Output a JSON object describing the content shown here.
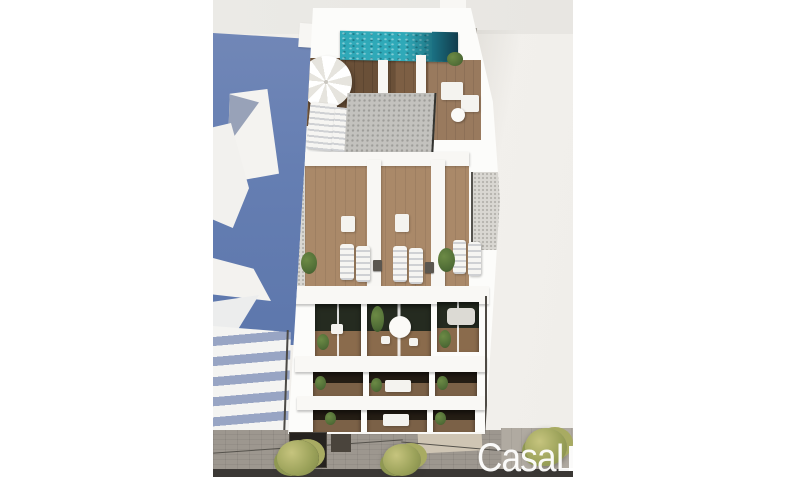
{
  "watermark": {
    "text": "CasaL"
  },
  "scene": {
    "kind": "aerial-architectural-render",
    "subject": "modern-white-apartment-building",
    "elements": [
      "rooftop-pool",
      "parasol",
      "roof-sun-loungers",
      "roof-core-gravel-roof",
      "terraces-with-loungers",
      "balcony-floor-round-table",
      "balcony-floor-sofa",
      "lower-balcony-strips",
      "street-pavement",
      "street-trees",
      "neighbor-shadow-wall",
      "neighbor-balcony-slabs"
    ]
  },
  "palette": {
    "page_bg": "#ffffff",
    "sky": "#eae9e5",
    "shadow_wall_blue": "#657eb2",
    "neighbor_shadow_blue": "#98a5c4",
    "sunlit_wall": "#f1efeb",
    "building_white": "#fcfcfa",
    "pool_teal": "#2fa9b8",
    "pool_deep": "#123c4c",
    "deck_wood_dark": "#6a5038",
    "terrace_wood": "#a9886a",
    "core_roof_gray": "#c3c2be",
    "gravel_gray": "#d9d7d2",
    "glass_dark": "#252b20",
    "street_gray": "#9d978f",
    "base_strip": "#3b3835",
    "tree_green": "#9aa159",
    "watermark_white": "#ffffff"
  }
}
